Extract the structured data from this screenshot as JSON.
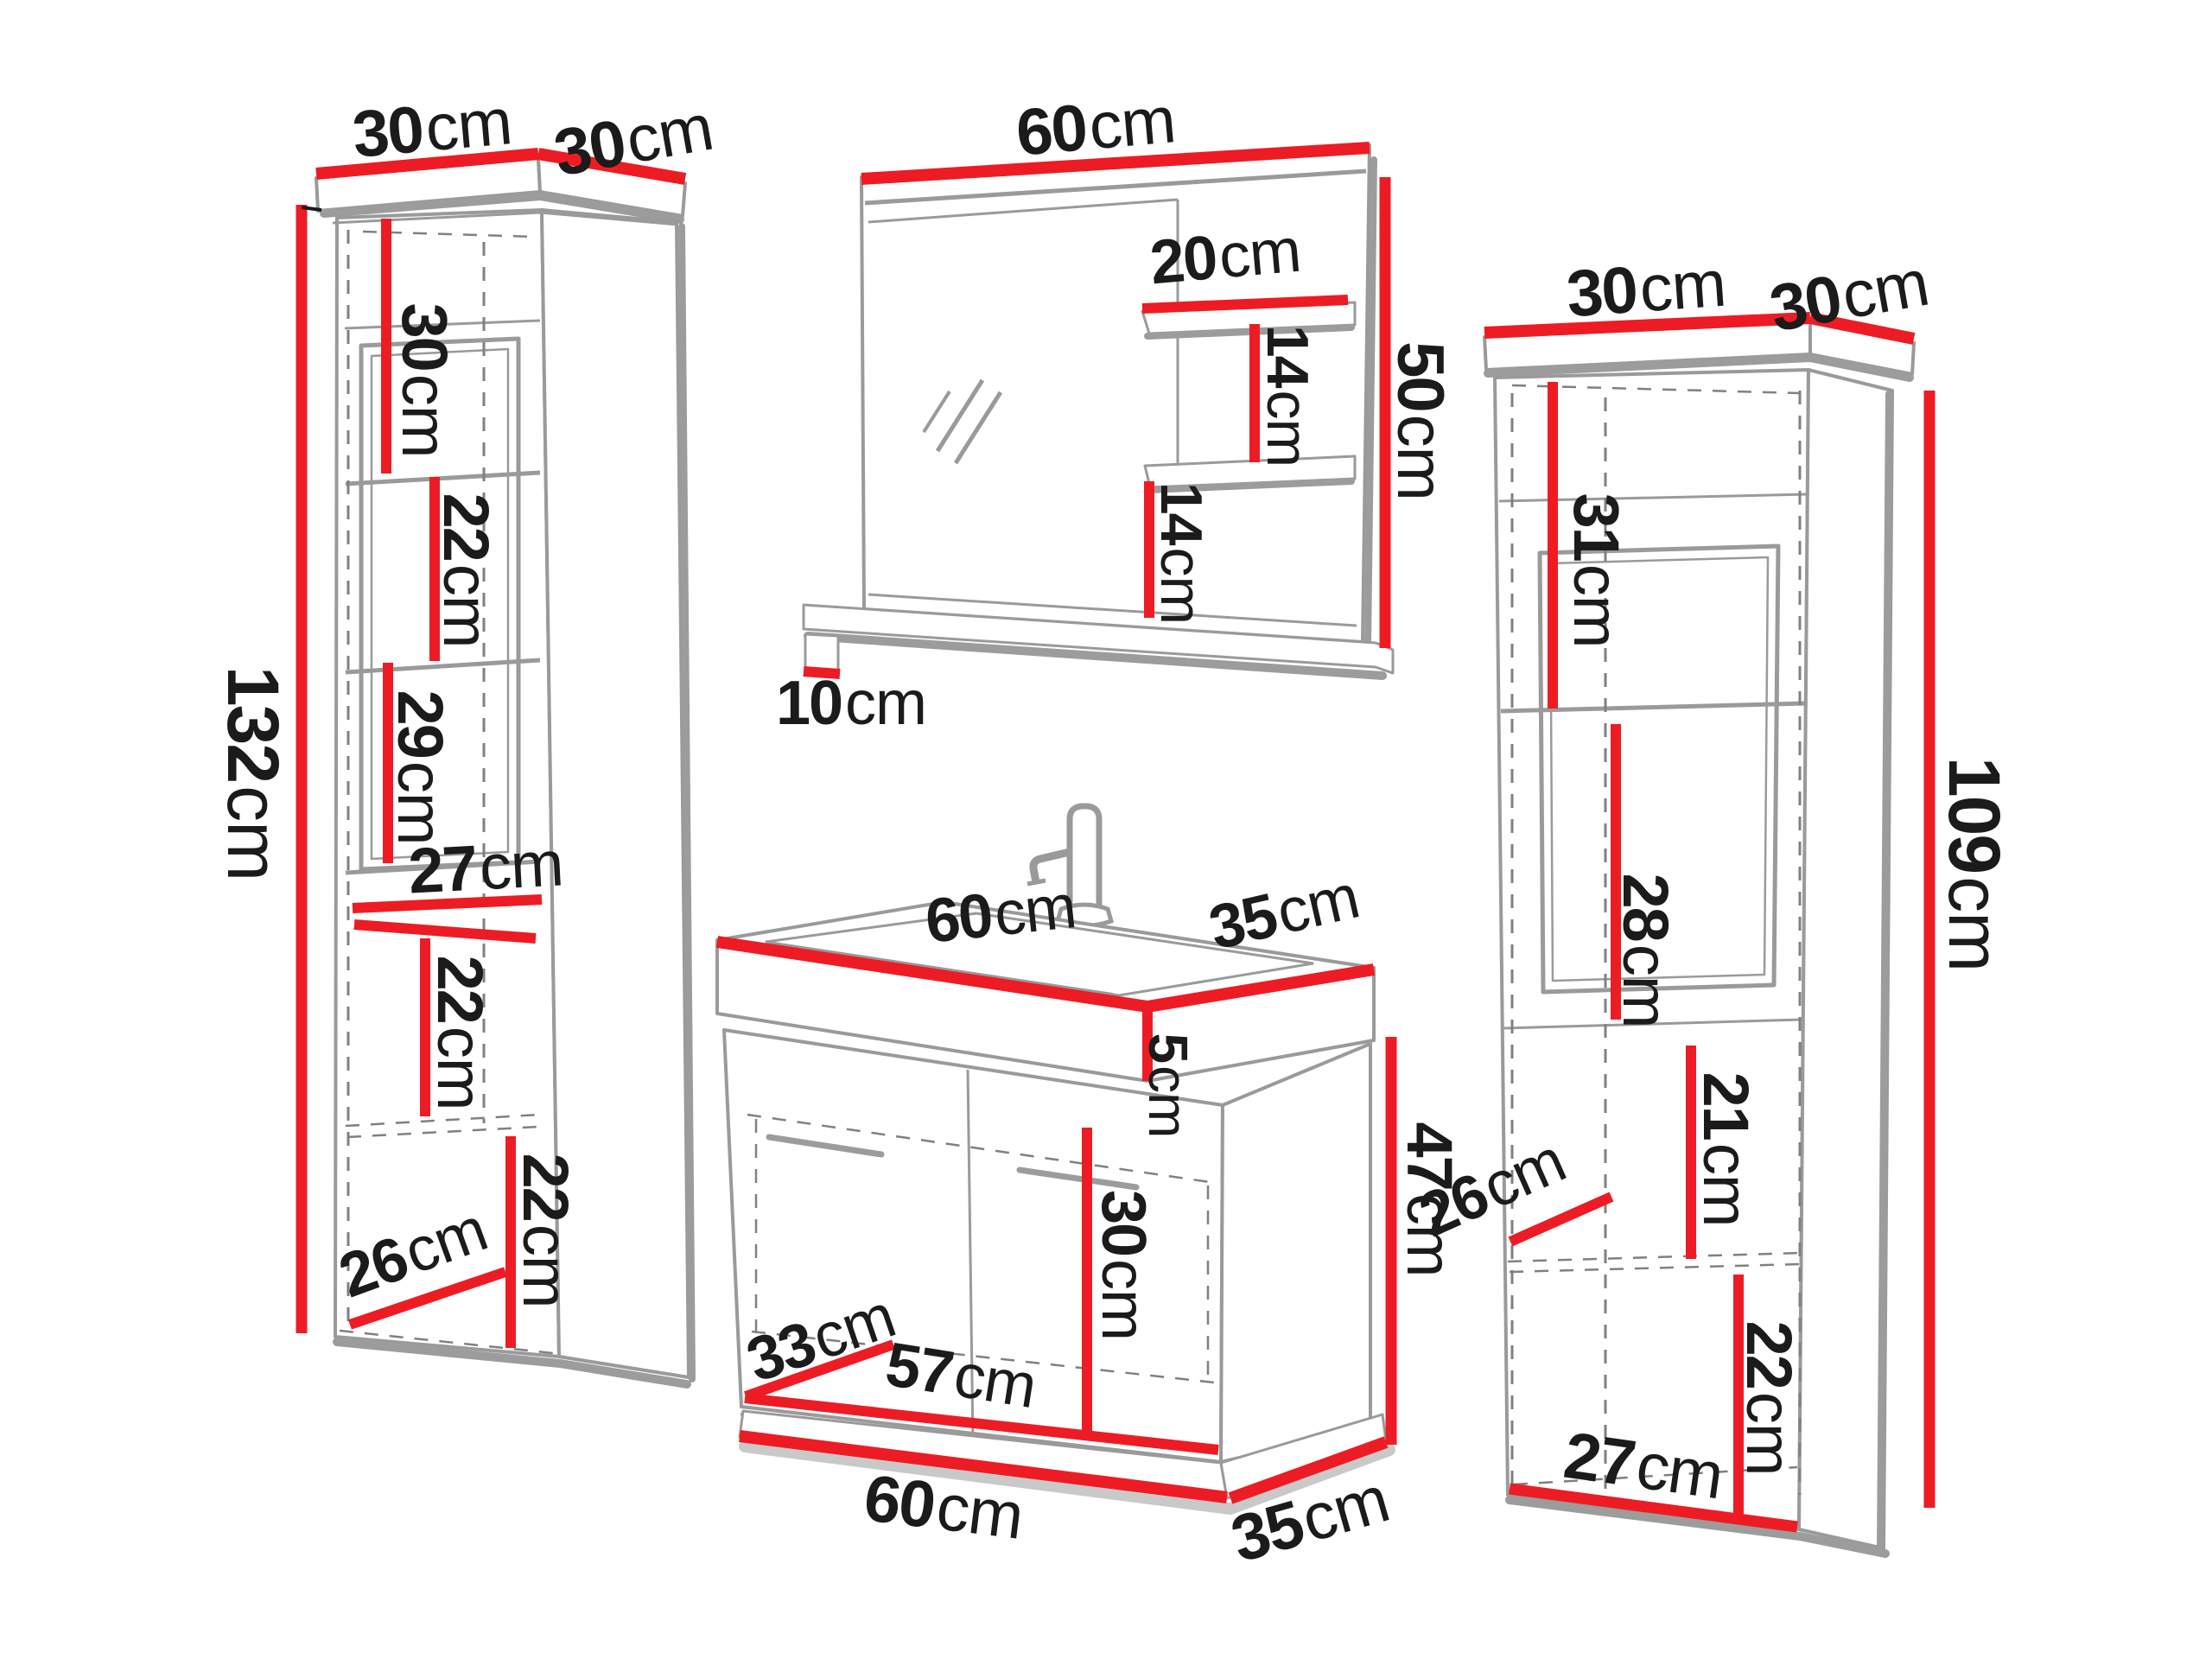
{
  "title": "bathroom furniture set dimensions diagram",
  "units": "cm",
  "colors": {
    "dimension_line_red": "#ed1c24",
    "outline_gray": "#9a9a9a",
    "label_black": "#1b1b1b",
    "background": "#ffffff"
  },
  "left_cabinet": {
    "top_width": {
      "v": "30",
      "u": "cm"
    },
    "top_depth": {
      "v": "30",
      "u": "cm"
    },
    "height": {
      "v": "132",
      "u": "cm"
    },
    "shelf_a": {
      "v": "30",
      "u": "cm"
    },
    "shelf_b": {
      "v": "22",
      "u": "cm"
    },
    "shelf_c": {
      "v": "29",
      "u": "cm"
    },
    "inner_width": {
      "v": "27",
      "u": "cm"
    },
    "shelf_d": {
      "v": "22",
      "u": "cm"
    },
    "shelf_e": {
      "v": "22",
      "u": "cm"
    },
    "inner_depth": {
      "v": "26",
      "u": "cm"
    }
  },
  "mirror": {
    "width": {
      "v": "60",
      "u": "cm"
    },
    "shelf_width": {
      "v": "20",
      "u": "cm"
    },
    "shelf_gap_upper": {
      "v": "14",
      "u": "cm"
    },
    "height": {
      "v": "50",
      "u": "cm"
    },
    "shelf_gap_lower": {
      "v": "14",
      "u": "cm"
    },
    "shelf_depth": {
      "v": "10",
      "u": "cm"
    }
  },
  "washbasin_cabinet": {
    "top_width": {
      "v": "60",
      "u": "cm"
    },
    "top_depth": {
      "v": "35",
      "u": "cm"
    },
    "basin_height": {
      "v": "5",
      "u": "cm"
    },
    "door_height": {
      "v": "30",
      "u": "cm"
    },
    "inner_depth": {
      "v": "33",
      "u": "cm"
    },
    "inner_width": {
      "v": "57",
      "u": "cm"
    },
    "body_height": {
      "v": "47",
      "u": "cm"
    },
    "bottom_width": {
      "v": "60",
      "u": "cm"
    },
    "bottom_depth": {
      "v": "35",
      "u": "cm"
    }
  },
  "right_cabinet": {
    "top_width": {
      "v": "30",
      "u": "cm"
    },
    "top_depth": {
      "v": "30",
      "u": "cm"
    },
    "shelf_a": {
      "v": "31",
      "u": "cm"
    },
    "shelf_b": {
      "v": "28",
      "u": "cm"
    },
    "height": {
      "v": "109",
      "u": "cm"
    },
    "shelf_c": {
      "v": "21",
      "u": "cm"
    },
    "inner_depth": {
      "v": "26",
      "u": "cm"
    },
    "shelf_d": {
      "v": "22",
      "u": "cm"
    },
    "bottom_width": {
      "v": "27",
      "u": "cm"
    }
  }
}
